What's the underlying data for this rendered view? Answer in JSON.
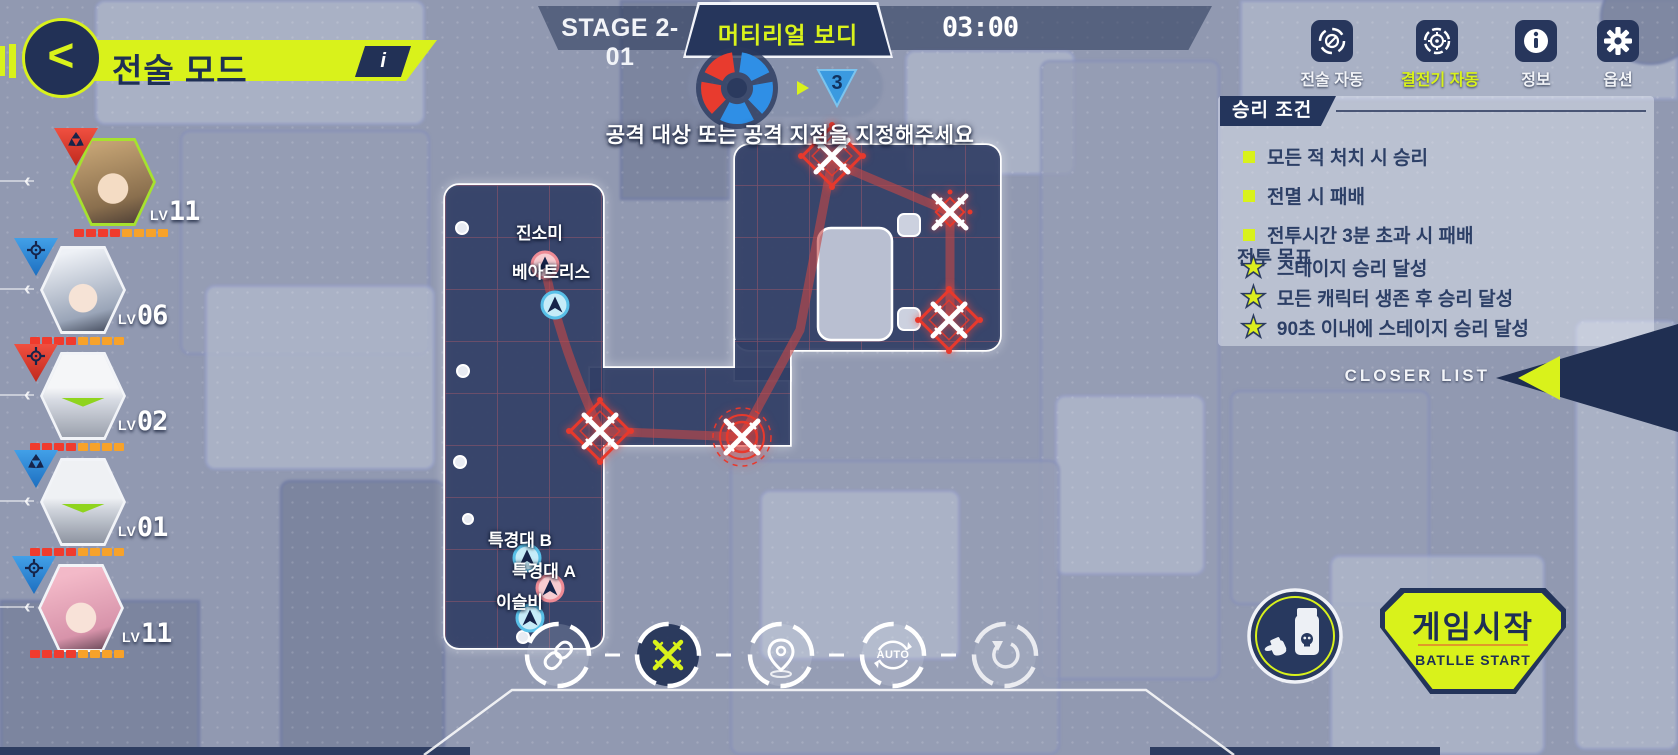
{
  "header": {
    "title": "전술 모드",
    "info": "i",
    "back": "<",
    "stage": "STAGE 2-01",
    "stage_name": "머티리얼 보디",
    "timer": "03:00",
    "turn_count": "3",
    "message": "공격 대상 또는 공격 지점을 지정해주세요"
  },
  "topbar": {
    "buttons": [
      {
        "label": "전술 자동",
        "active": false
      },
      {
        "label": "결전기 자동",
        "active": true
      },
      {
        "label": "정보",
        "active": false
      },
      {
        "label": "옵션",
        "active": false
      }
    ]
  },
  "victory": {
    "title": "승리 조건",
    "conditions": [
      "모든 적 처치 시 승리",
      "전멸 시 패배",
      "전투시간 3분 초과 시 패배"
    ],
    "objective_title": "전투 목표",
    "objectives": [
      "스테이지 승리 달성",
      "모든 캐릭터 생존 후 승리 달성",
      "90초 이내에 스테이지 승리 달성"
    ],
    "star_glyph": "★"
  },
  "closer": {
    "label": "CLOSER LIST"
  },
  "party": {
    "lv_label": "LV",
    "members": [
      {
        "level": "11",
        "badge": "red-triblade",
        "selected": true
      },
      {
        "level": "06",
        "badge": "blue-crosshair",
        "selected": false
      },
      {
        "level": "02",
        "badge": "red-crosshair",
        "selected": false
      },
      {
        "level": "01",
        "badge": "blue-triblade",
        "selected": false
      },
      {
        "level": "11",
        "badge": "blue-crosshair",
        "selected": false
      }
    ]
  },
  "map": {
    "units": [
      {
        "name": "진소미",
        "color": "red"
      },
      {
        "name": "베아트리스",
        "color": "blue"
      },
      {
        "name": "특경대 B",
        "color": "blue"
      },
      {
        "name": "특경대 A",
        "color": "red"
      },
      {
        "name": "이슬비",
        "color": "blue"
      }
    ],
    "enemy_count": 5
  },
  "actions": {
    "auto_label": "AUTO"
  },
  "start": {
    "title": "게임시작",
    "subtitle": "BATLLE START"
  },
  "colors": {
    "accent": "#d9f21b",
    "navy": "#24355c",
    "enemy_red": "#e8392c",
    "hp_red": "#f03b2d",
    "hp_orange": "#f7a22a"
  }
}
